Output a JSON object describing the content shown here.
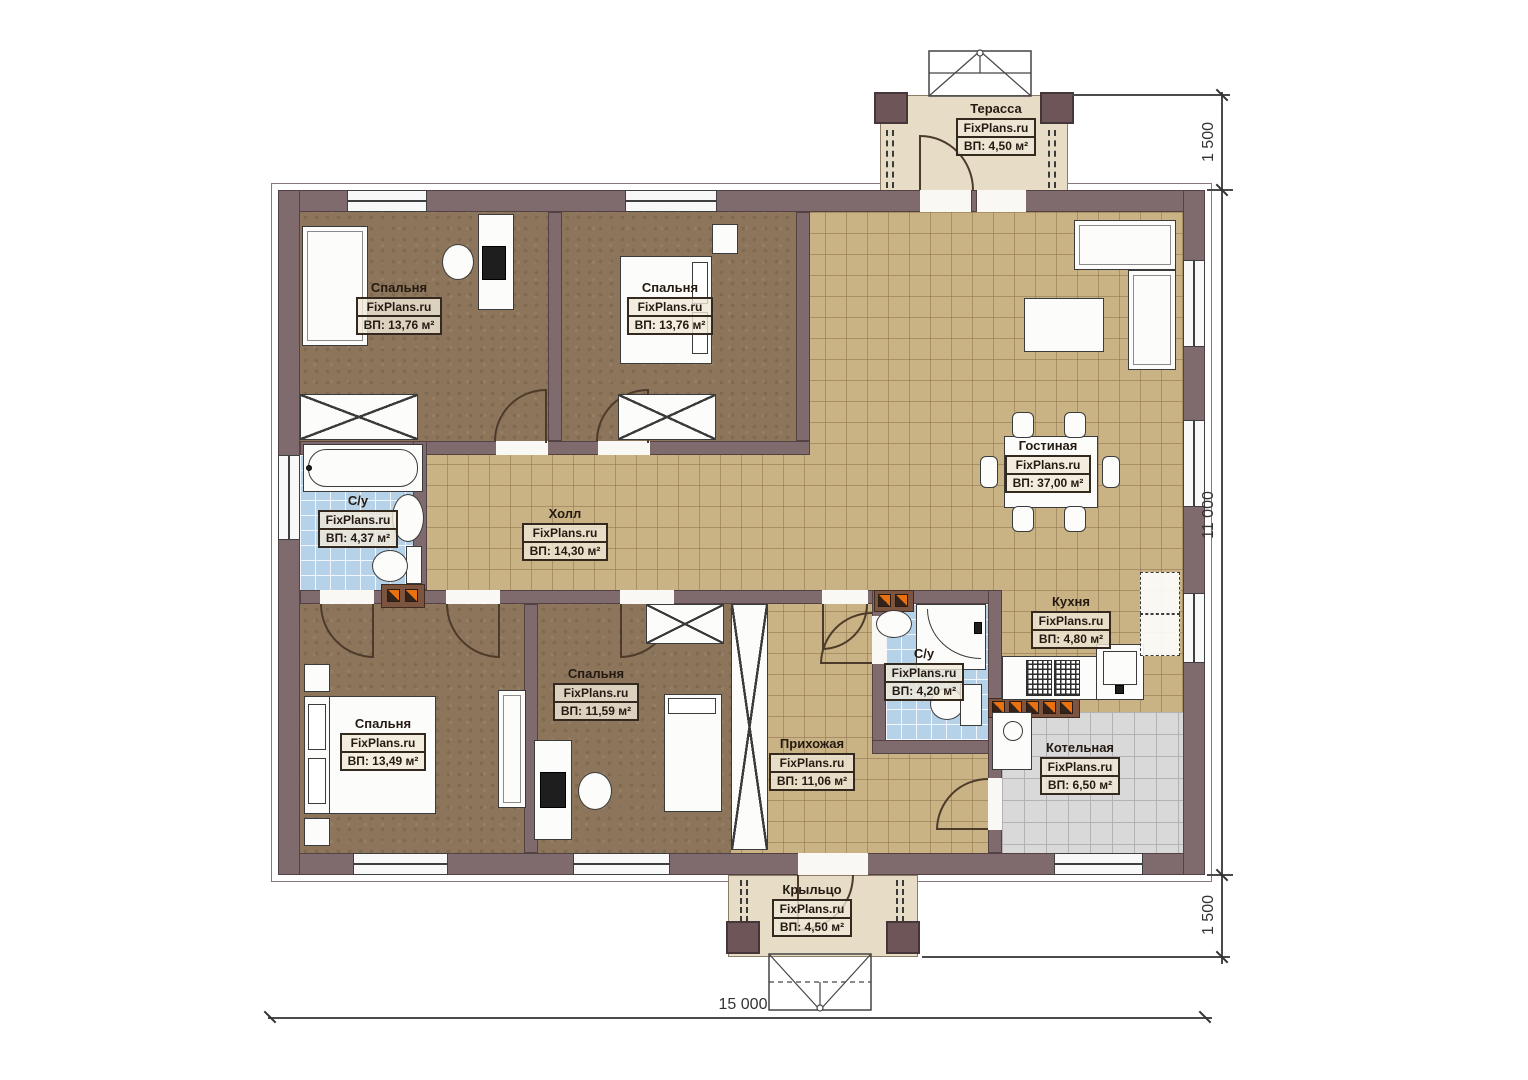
{
  "plan": {
    "brand": "FixPlans.ru",
    "rooms": [
      {
        "id": "terrace",
        "name": "Терасса",
        "area": "ВП: 4,50 м²"
      },
      {
        "id": "bedroom1",
        "name": "Спальня",
        "area": "ВП: 13,76 м²"
      },
      {
        "id": "bedroom2",
        "name": "Спальня",
        "area": "ВП: 13,76 м²"
      },
      {
        "id": "living",
        "name": "Гостиная",
        "area": "ВП: 37,00 м²"
      },
      {
        "id": "hall",
        "name": "Холл",
        "area": "ВП: 14,30 м²"
      },
      {
        "id": "bath1",
        "name": "С/у",
        "area": "ВП: 4,37 м²"
      },
      {
        "id": "bedroom3",
        "name": "Спальня",
        "area": "ВП: 13,49 м²"
      },
      {
        "id": "bedroom4",
        "name": "Спальня",
        "area": "ВП: 11,59 м²"
      },
      {
        "id": "entry",
        "name": "Прихожая",
        "area": "ВП: 11,06 м²"
      },
      {
        "id": "bath2",
        "name": "С/у",
        "area": "ВП: 4,20 м²"
      },
      {
        "id": "kitchen",
        "name": "Кухня",
        "area": "ВП: 4,80 м²"
      },
      {
        "id": "boiler",
        "name": "Котельная",
        "area": "ВП: 6,50 м²"
      },
      {
        "id": "porch",
        "name": "Крыльцо",
        "area": "ВП: 4,50 м²"
      }
    ],
    "dimensions": {
      "top_right": "1 500",
      "right": "11 000",
      "bottom_right": "1 500",
      "bottom": "15 000"
    },
    "colors": {
      "wall": "#7f6b6d",
      "tile": "#c9b284",
      "carpet": "#8c755a",
      "wet_tile": "#b6d2e9",
      "boiler_tile": "#d9d9d9",
      "deck": "#e7dcc6",
      "marker_orange": "#ea7110"
    }
  }
}
